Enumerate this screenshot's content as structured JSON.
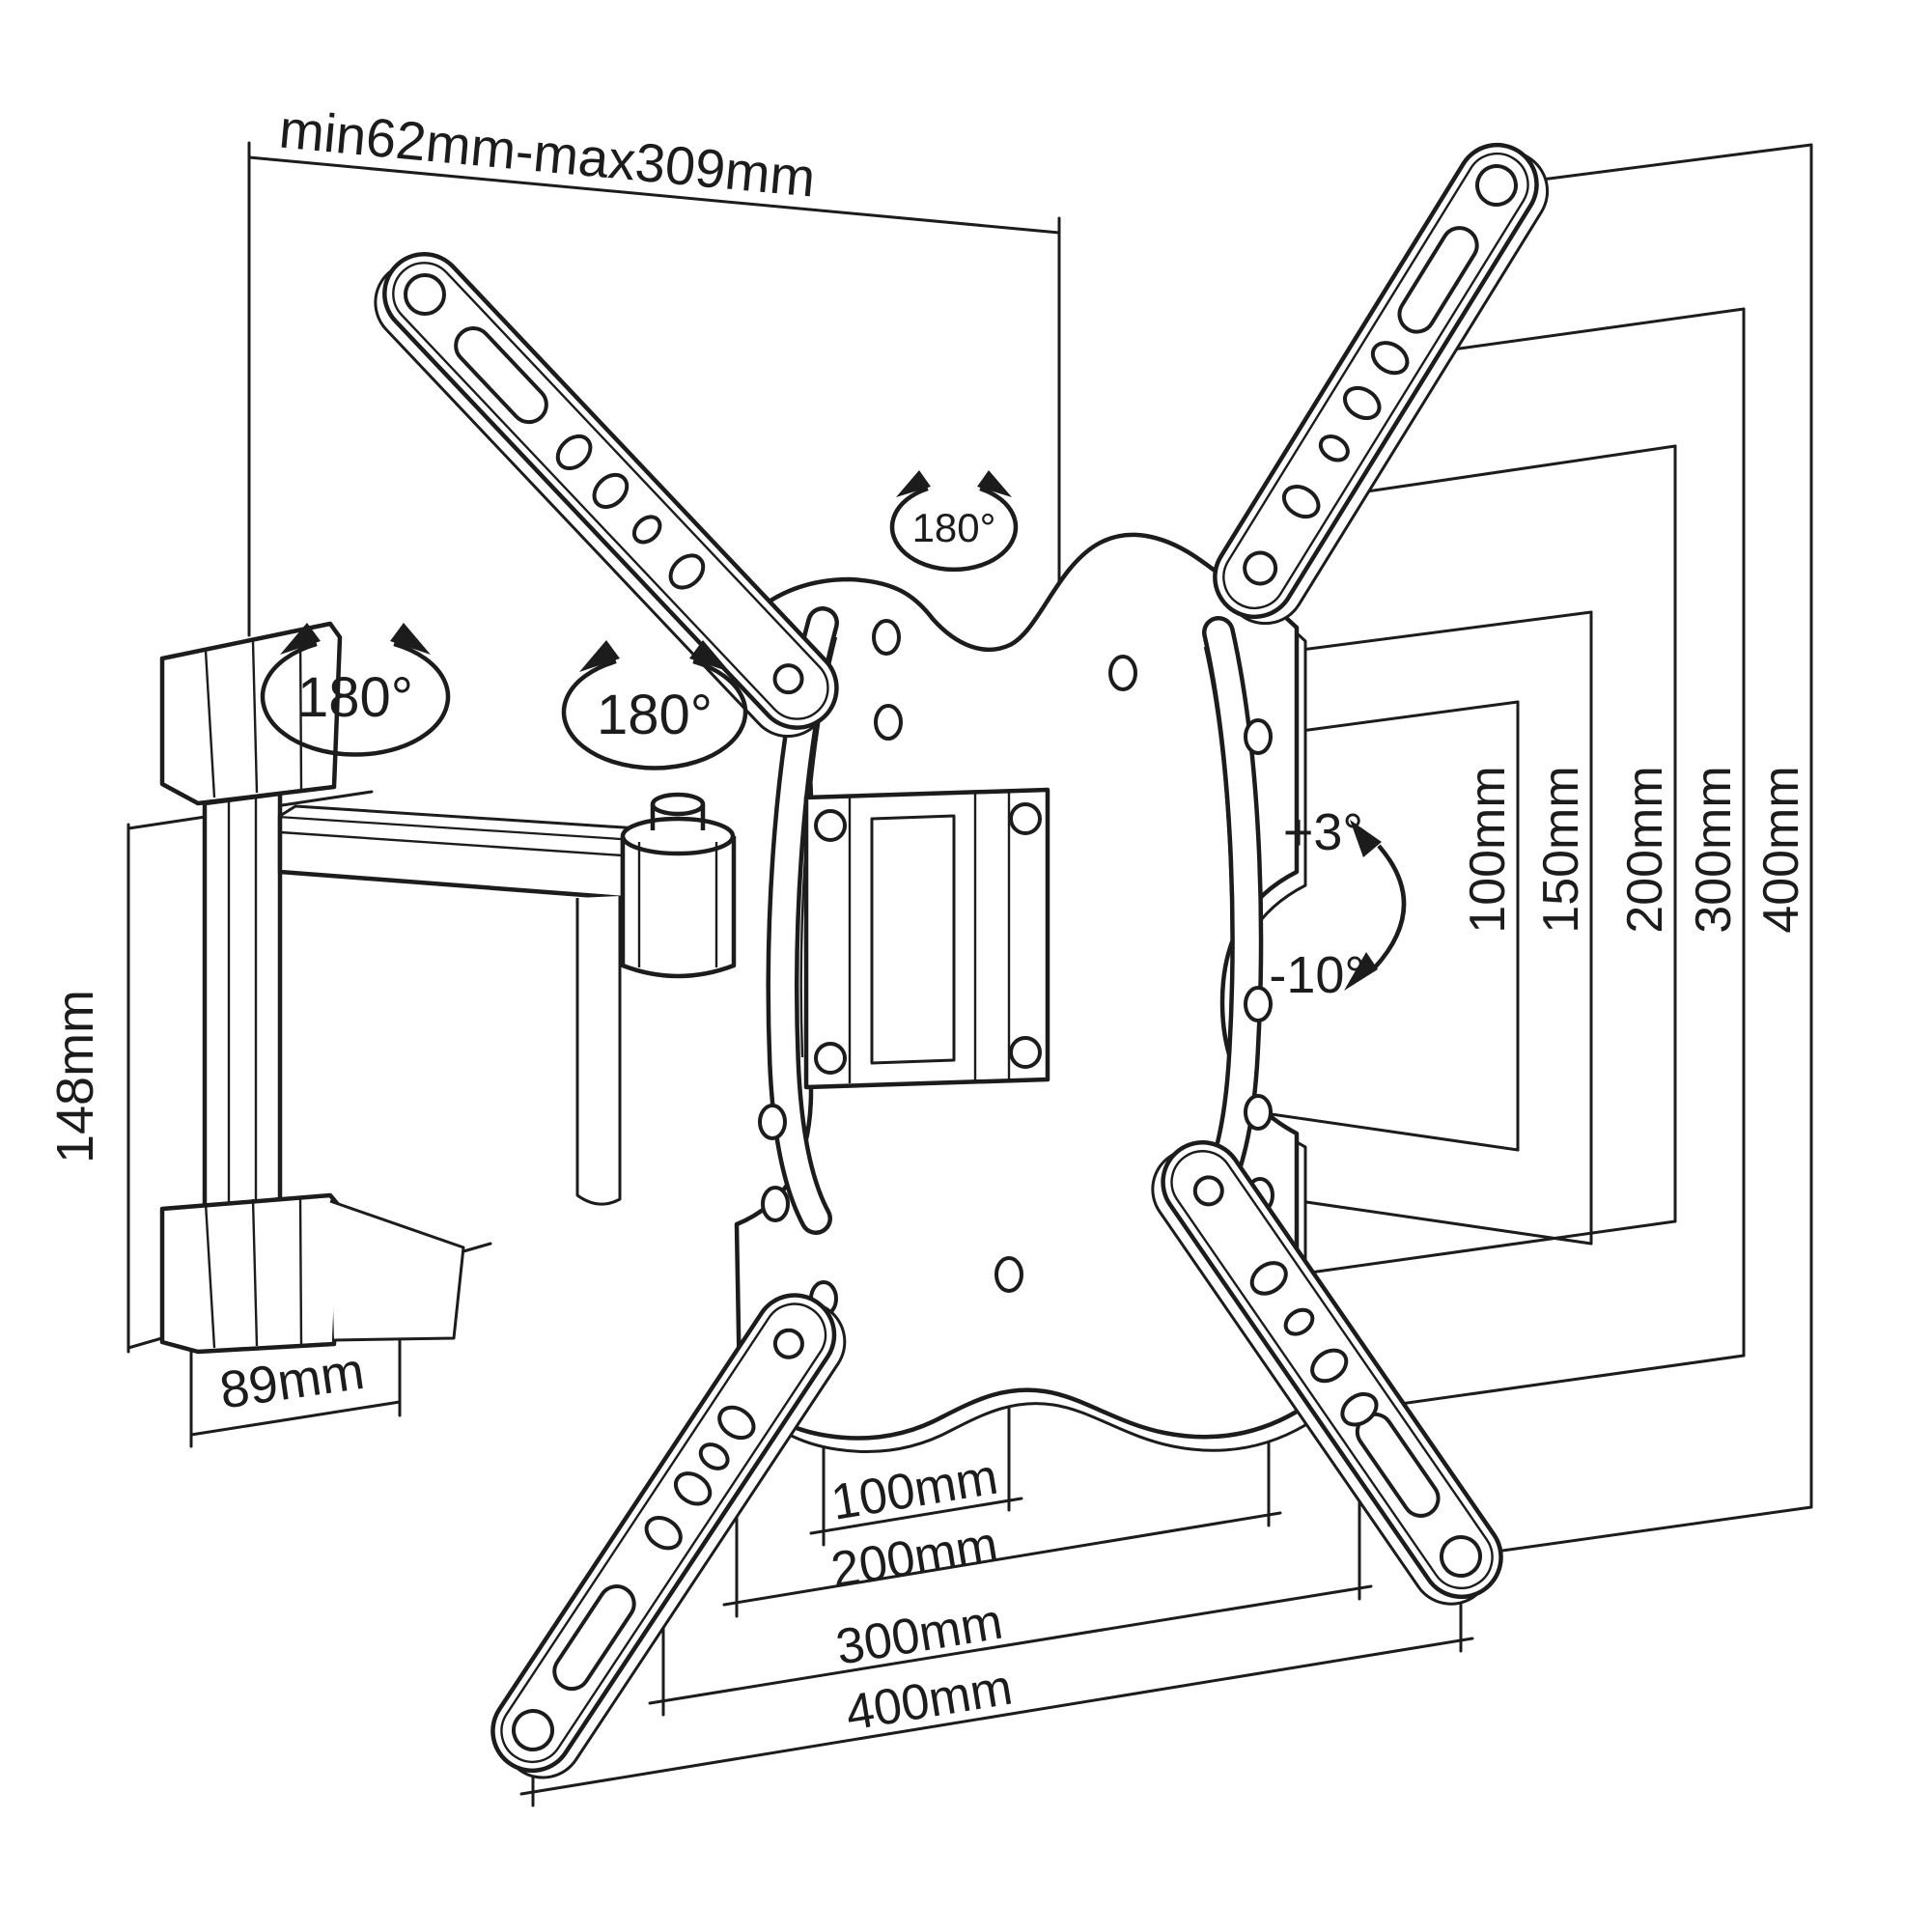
{
  "meta": {
    "description": "Technical line drawing of a full-motion articulating TV wall mount bracket with VESA hole-pattern dimensions",
    "ink_color": "#1c1c1c",
    "background": "#ffffff"
  },
  "labels": {
    "extension_range": "min62mm-max309mm",
    "wall_bracket_height": "148mm",
    "wall_bracket_depth": "89mm",
    "swivel_wall": "180°",
    "swivel_arm": "180°",
    "swivel_plate": "180°",
    "tilt_up": "+3°",
    "tilt_down": "-10°"
  },
  "vesa_right": [
    "100mm",
    "150mm",
    "200mm",
    "300mm",
    "400mm"
  ],
  "vesa_bottom": [
    "100mm",
    "200mm",
    "300mm",
    "400mm"
  ]
}
